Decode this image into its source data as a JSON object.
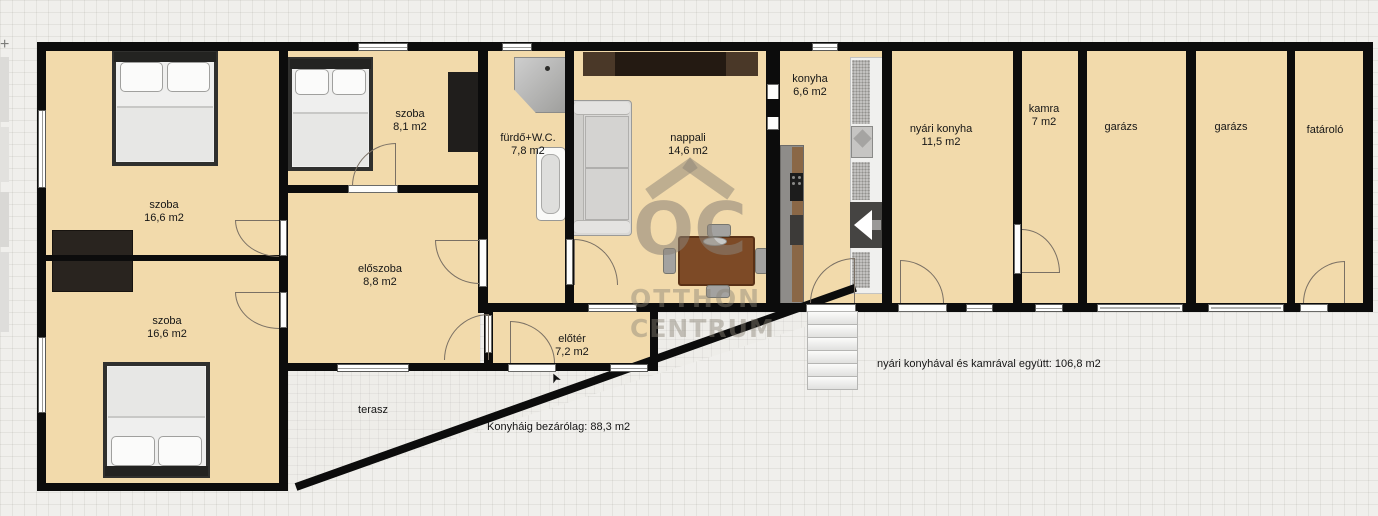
{
  "marker": "+",
  "rooms": {
    "szoba_top": {
      "name": "szoba",
      "area": "16,6 m2"
    },
    "szoba_small": {
      "name": "szoba",
      "area": "8,1 m2"
    },
    "furdo": {
      "name": "fürdő+W.C.",
      "area": "7,8 m2"
    },
    "nappali": {
      "name": "nappali",
      "area": "14,6 m2"
    },
    "konyha": {
      "name": "konyha",
      "area": "6,6 m2"
    },
    "nyari_konyha": {
      "name": "nyári konyha",
      "area": "11,5 m2"
    },
    "kamra": {
      "name": "kamra",
      "area": "7 m2"
    },
    "garazs_1": {
      "name": "garázs"
    },
    "garazs_2": {
      "name": "garázs"
    },
    "fatarolo": {
      "name": "fatároló"
    },
    "eloszoba": {
      "name": "előszoba",
      "area": "8,8 m2"
    },
    "eloter": {
      "name": "előtér",
      "area": "7,2 m2"
    },
    "szoba_bottom": {
      "name": "szoba",
      "area": "16,6 m2"
    },
    "terasz": {
      "name": "terasz"
    }
  },
  "annotations": {
    "total_to_kitchen": "Konyháig bezárólag: 88,3 m2",
    "total_with_summer_kitchen": "nyári konyhával és kamrával együtt: 106,8 m2"
  },
  "watermark": {
    "monogram": "OC",
    "line1": "OTTHON",
    "line2": "CENTRUM"
  },
  "colors": {
    "room_fill": "#f2daab",
    "wall": "#0c0c0c",
    "background": "#f0efec",
    "watermark": "#8a8276",
    "table_wood": "#7d4a26"
  }
}
